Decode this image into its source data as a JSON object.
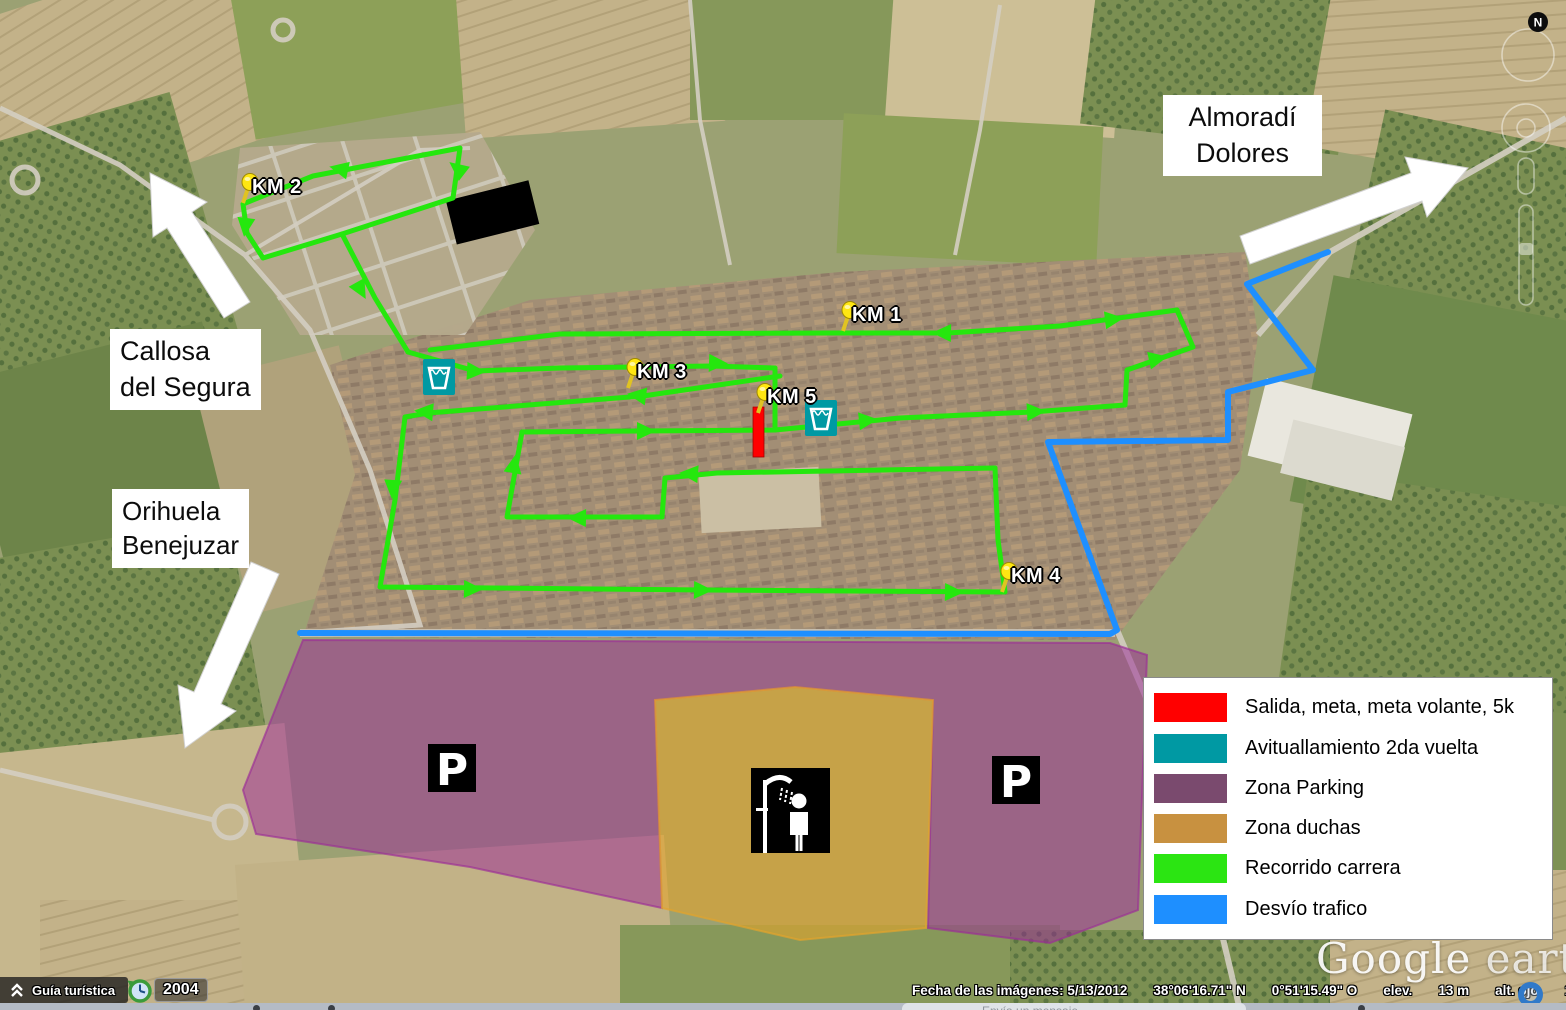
{
  "app": {
    "watermark_google": "Google",
    "watermark_earth": "earth"
  },
  "compass_north": "N",
  "direction_labels": [
    {
      "id": "almoradi",
      "lines": [
        "Almoradí",
        "Dolores"
      ]
    },
    {
      "id": "callosa",
      "lines": [
        "Callosa",
        "del Segura"
      ]
    },
    {
      "id": "orihuela",
      "lines": [
        "Orihuela",
        "Benejuzar"
      ]
    }
  ],
  "legend": {
    "items": [
      {
        "label": "Salida, meta, meta volante, 5k",
        "color": "#ff0000"
      },
      {
        "label": "Avituallamiento 2da vuelta",
        "color": "#0099a3"
      },
      {
        "label": "Zona Parking",
        "color": "#7a4a6e"
      },
      {
        "label": "Zona duchas",
        "color": "#c89140"
      },
      {
        "label": "Recorrido carrera",
        "color": "#2be512"
      },
      {
        "label": "Desvío trafico",
        "color": "#1e8fff"
      }
    ]
  },
  "km_markers": [
    {
      "label": "KM 1",
      "x": 843,
      "y": 331
    },
    {
      "label": "KM 2",
      "x": 243,
      "y": 203
    },
    {
      "label": "KM 3",
      "x": 628,
      "y": 388
    },
    {
      "label": "KM 4",
      "x": 1002,
      "y": 592
    },
    {
      "label": "KM 5",
      "x": 758,
      "y": 413
    }
  ],
  "parking_icons": [
    {
      "label": "P",
      "x": 428,
      "y": 744
    },
    {
      "label": "P",
      "x": 992,
      "y": 756
    }
  ],
  "aid_stations": [
    {
      "x": 439,
      "y": 377
    },
    {
      "x": 821,
      "y": 418
    }
  ],
  "shower_icon": {
    "x": 751,
    "y": 768,
    "w": 79,
    "h": 85
  },
  "start_finish_bar": {
    "x": 753,
    "y": 407,
    "w": 11,
    "h": 50,
    "color": "#ff0000"
  },
  "routes": {
    "race": {
      "color": "#25e70e",
      "segments": [
        [
          [
            460,
            148
          ],
          [
            313,
            176
          ],
          [
            243,
            204
          ],
          [
            247,
            233
          ],
          [
            263,
            258
          ],
          [
            342,
            234
          ],
          [
            453,
            198
          ],
          [
            460,
            148
          ]
        ],
        [
          [
            342,
            234
          ],
          [
            375,
            298
          ],
          [
            408,
            352
          ]
        ],
        [
          [
            408,
            352
          ],
          [
            475,
            371
          ],
          [
            560,
            368
          ],
          [
            712,
            366
          ],
          [
            775,
            368
          ]
        ],
        [
          [
            775,
            368
          ],
          [
            775,
            430
          ]
        ],
        [
          [
            780,
            376
          ],
          [
            643,
            396
          ],
          [
            428,
            413
          ],
          [
            405,
            417
          ],
          [
            395,
            500
          ],
          [
            380,
            587
          ],
          [
            707,
            590
          ],
          [
            1005,
            592
          ],
          [
            998,
            540
          ],
          [
            995,
            468
          ]
        ],
        [
          [
            522,
            432
          ],
          [
            507,
            517
          ],
          [
            662,
            517
          ],
          [
            665,
            478
          ],
          [
            717,
            473
          ],
          [
            995,
            468
          ]
        ],
        [
          [
            522,
            432
          ],
          [
            640,
            431
          ],
          [
            775,
            430
          ],
          [
            900,
            418
          ],
          [
            1032,
            412
          ],
          [
            1125,
            405
          ]
        ],
        [
          [
            1125,
            405
          ],
          [
            1127,
            370
          ],
          [
            1193,
            347
          ],
          [
            1177,
            310
          ]
        ],
        [
          [
            430,
            350
          ],
          [
            560,
            334
          ],
          [
            830,
            333
          ],
          [
            948,
            333
          ],
          [
            1060,
            326
          ],
          [
            1177,
            310
          ]
        ]
      ],
      "arrows": [
        [
          345,
          170,
          192
        ],
        [
          246,
          221,
          97
        ],
        [
          358,
          285,
          61
        ],
        [
          470,
          371,
          3
        ],
        [
          712,
          363,
          2
        ],
        [
          948,
          333,
          181
        ],
        [
          1108,
          320,
          -7
        ],
        [
          643,
          396,
          188
        ],
        [
          430,
          412,
          185
        ],
        [
          393,
          483,
          94
        ],
        [
          467,
          589,
          1
        ],
        [
          697,
          590,
          1
        ],
        [
          948,
          592,
          1
        ],
        [
          513,
          470,
          -80
        ],
        [
          583,
          518,
          181
        ],
        [
          695,
          474,
          184
        ],
        [
          640,
          431,
          0
        ],
        [
          1030,
          412,
          -3
        ],
        [
          862,
          421,
          -6
        ],
        [
          1152,
          360,
          -12
        ],
        [
          462,
          172,
          218
        ]
      ]
    },
    "detour": {
      "color": "#1e8fff",
      "points": [
        [
          1328,
          252
        ],
        [
          1247,
          284
        ],
        [
          1313,
          370
        ],
        [
          1228,
          392
        ],
        [
          1228,
          440
        ],
        [
          1048,
          442
        ],
        [
          1117,
          630
        ],
        [
          1110,
          634
        ],
        [
          300,
          633
        ]
      ]
    }
  },
  "zones": {
    "parking": {
      "color": "#9b2c97",
      "points": [
        [
          303,
          640
        ],
        [
          1110,
          643
        ],
        [
          1147,
          655
        ],
        [
          1138,
          910
        ],
        [
          1050,
          943
        ],
        [
          928,
          928
        ],
        [
          933,
          700
        ],
        [
          795,
          687
        ],
        [
          655,
          700
        ],
        [
          662,
          908
        ],
        [
          470,
          867
        ],
        [
          256,
          834
        ],
        [
          243,
          790
        ]
      ]
    },
    "showers": {
      "color": "#e2a42c",
      "points": [
        [
          655,
          700
        ],
        [
          795,
          687
        ],
        [
          933,
          700
        ],
        [
          926,
          928
        ],
        [
          800,
          940
        ],
        [
          662,
          908
        ]
      ]
    }
  },
  "white_arrows": [
    {
      "id": "to-callosa",
      "points": [
        [
          250,
          302
        ],
        [
          192,
          212
        ],
        [
          207,
          202
        ],
        [
          150,
          173
        ],
        [
          153,
          237
        ],
        [
          167,
          228
        ],
        [
          224,
          318
        ]
      ]
    },
    {
      "id": "to-orihuela",
      "points": [
        [
          251,
          562
        ],
        [
          194,
          692
        ],
        [
          178,
          685
        ],
        [
          185,
          748
        ],
        [
          236,
          711
        ],
        [
          221,
          704
        ],
        [
          279,
          574
        ]
      ]
    },
    {
      "id": "to-almoradi",
      "points": [
        [
          1250,
          264
        ],
        [
          1422,
          201
        ],
        [
          1427,
          217
        ],
        [
          1468,
          168
        ],
        [
          1405,
          157
        ],
        [
          1411,
          173
        ],
        [
          1240,
          236
        ]
      ]
    }
  ],
  "toolbar": {
    "guide_label": "Guía turística",
    "year": "2004"
  },
  "status_bar": {
    "items": [
      "Fecha de las imágenes: 5/13/2012",
      "38°06'16.71\" N",
      "0°51'15.49\" O",
      "elev.",
      "13 m",
      "alt. ojo",
      "1.08 km"
    ]
  },
  "bottom_strip": {
    "text": "Envía un mensaje"
  }
}
